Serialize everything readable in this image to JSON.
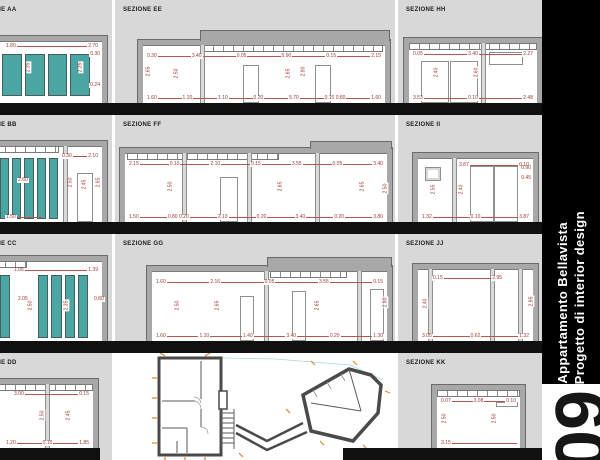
{
  "sheet": {
    "strip": {
      "line1": "Appartamento Bellavista",
      "line2": "Progetto di interior design",
      "sheet_number": "09"
    },
    "colors": {
      "panel_bg": "#d8d8d8",
      "wall_gray": "#a8a8a8",
      "wall_outline": "#6b6b6b",
      "dimension_red": "#a03a2e",
      "cabinet_teal": "#4aa5a3",
      "floor_black": "#101010",
      "strip_bg": "#000000",
      "strip_text": "#ffffff",
      "plan_marker_orange": "#e0862f"
    }
  },
  "sections": {
    "aa": {
      "title": "SEZIONE AA",
      "dims_top": [
        "1.80",
        "2.70"
      ],
      "dims_mid": [
        "2.35",
        "2.35"
      ],
      "dims_right": [
        "0.30",
        "0.24"
      ]
    },
    "bb": {
      "title": "SEZIONE BB",
      "dims_top": [
        "0.30",
        "2.10"
      ],
      "dims_mid": [
        "2.60"
      ],
      "dims_vertical": [
        "2.50",
        "2.45",
        "2.65"
      ],
      "dims_bottom": [
        "1.50"
      ]
    },
    "cc": {
      "title": "SEZIONE CC",
      "dims_top": [
        "1.06",
        "1.39"
      ],
      "dims_mid": [
        "2.05",
        "0.80"
      ],
      "dims_vertical": [
        "2.50",
        "2.35"
      ]
    },
    "dd": {
      "title": "SEZIONE DD",
      "dims_top": [
        "3.00",
        "0.15"
      ],
      "dims_bottom": [
        "1.20",
        "0.10",
        "1.85"
      ],
      "dims_vertical": [
        "2.50",
        "2.45"
      ]
    },
    "ee": {
      "title": "SEZIONE EE",
      "dims_top": [
        "0.30",
        "3.40",
        "0.05",
        "5.90",
        "0.15",
        "2.15"
      ],
      "dims_bottom": [
        "1.60",
        "1.10",
        "1.10",
        "0.20",
        "5.70",
        "0.10 0.80",
        "1.60"
      ],
      "dims_vertical": [
        "2.65",
        "2.50",
        "2.65",
        "2.90"
      ]
    },
    "ff": {
      "title": "SEZIONE FF",
      "dims_top": [
        "2.15",
        "0.10",
        "2.10",
        "0.15",
        "3.55",
        "0.05",
        "3.40"
      ],
      "dims_bottom": [
        "1.50",
        "0.80 0.20",
        "2.10",
        "0.20",
        "3.40",
        "0.20",
        "3.80"
      ],
      "dims_vertical": [
        "2.50",
        "2.65",
        "2.65",
        "2.50"
      ]
    },
    "gg": {
      "title": "SEZIONE GG",
      "dims_top": [
        "1.60",
        "2.16",
        "0.05",
        "3.55",
        "0.15"
      ],
      "dims_bottom": [
        "1.60",
        "1.10",
        "1.40",
        "3.40",
        "0.20",
        "1.30"
      ],
      "dims_vertical": [
        "2.50",
        "2.65",
        "2.65",
        "2.90"
      ]
    },
    "hh": {
      "title": "SEZIONE HH",
      "dims_top": [
        "0.05",
        "3.40",
        "2.27"
      ],
      "dims_bottom": [
        "3.53",
        "0.10",
        "2.48"
      ],
      "dims_vertical": [
        "2.40",
        "2.60"
      ]
    },
    "ii": {
      "title": "SEZIONE II",
      "dims_top": [
        "3.87",
        "0.10"
      ],
      "dims_bottom": [
        "1.32",
        "0.10",
        "3.87"
      ],
      "dims_vertical": [
        "2.55",
        "2.40"
      ],
      "dims_right": [
        "0.90",
        "0.45"
      ]
    },
    "jj": {
      "title": "SEZIONE JJ",
      "dims_top": [
        "0.15",
        "2.95"
      ],
      "dims_bottom": [
        "3.05",
        "0.62",
        "1.32"
      ],
      "dims_vertical": [
        "2.40",
        "2.95"
      ]
    },
    "kk": {
      "title": "SEZIONE KK",
      "dims_top": [
        "0.07",
        "3.08",
        "0.10"
      ],
      "dims_bottom": [
        "3.15"
      ],
      "dims_vertical": [
        "2.50",
        "2.50"
      ]
    }
  }
}
